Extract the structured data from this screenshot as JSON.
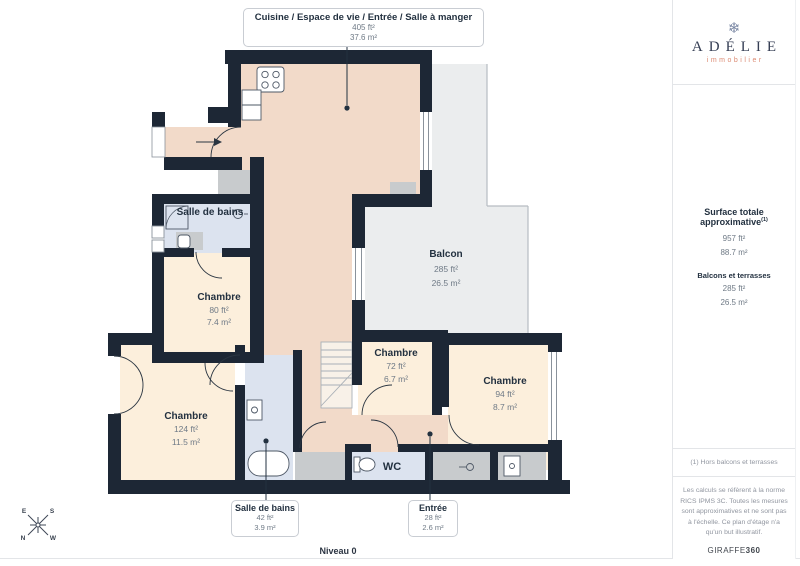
{
  "callouts": {
    "living": {
      "title": "Cuisine / Espace de vie / Entrée / Salle à manger",
      "ft": "405 ft²",
      "m": "37.6 m²"
    },
    "bathroom": {
      "title": "Salle de bains",
      "ft": "42 ft²",
      "m": "3.9 m²"
    },
    "entry": {
      "title": "Entrée",
      "ft": "28 ft²",
      "m": "2.6 m²"
    }
  },
  "rooms": {
    "bathroom_top": {
      "label": "Salle de bains"
    },
    "bedroom_small": {
      "label": "Chambre",
      "ft": "80 ft²",
      "m": "7.4 m²"
    },
    "balcony": {
      "label": "Balcon",
      "ft": "285 ft²",
      "m": "26.5 m²"
    },
    "bedroom_center": {
      "label": "Chambre",
      "ft": "72 ft²",
      "m": "6.7 m²"
    },
    "bedroom_right": {
      "label": "Chambre",
      "ft": "94 ft²",
      "m": "8.7 m²"
    },
    "bedroom_left": {
      "label": "Chambre",
      "ft": "124 ft²",
      "m": "11.5 m²"
    },
    "wc": {
      "label": "WC"
    }
  },
  "footer": {
    "level": "Niveau 0"
  },
  "compass": {
    "e": "E",
    "s": "S",
    "n": "N",
    "w": "W"
  },
  "sidebar": {
    "brand": {
      "name": "ADÉLIE",
      "tagline": "immobilier"
    },
    "totals": {
      "title": "Surface totale approximative",
      "title_sup": "(1)",
      "total_ft": "957 ft²",
      "total_m": "88.7 m²",
      "balconies_title": "Balcons et terrasses",
      "balconies_ft": "285 ft²",
      "balconies_m": "26.5 m²"
    },
    "footnote": "(1) Hors balcons et terrasses",
    "disclaimer": "Les calculs se réfèrent à la norme RICS IPMS 3C. Toutes les mesures sont approximatives et ne sont pas à l'échelle. Ce plan d'étage n'a qu'un but illustratif.",
    "brand_footer": {
      "normal": "GIRAFFE",
      "bold": "360"
    }
  },
  "colors": {
    "wall": "#1d2735",
    "living": "#f2dac9",
    "bedroom": "#fcefdc",
    "bathroom": "#dce3ef",
    "balcony": "#ebedee",
    "closet": "#c8cbcd",
    "ink": "#233140",
    "muted": "#6f7a86",
    "line": "#e3e5e8",
    "coral": "#dc8a72"
  }
}
